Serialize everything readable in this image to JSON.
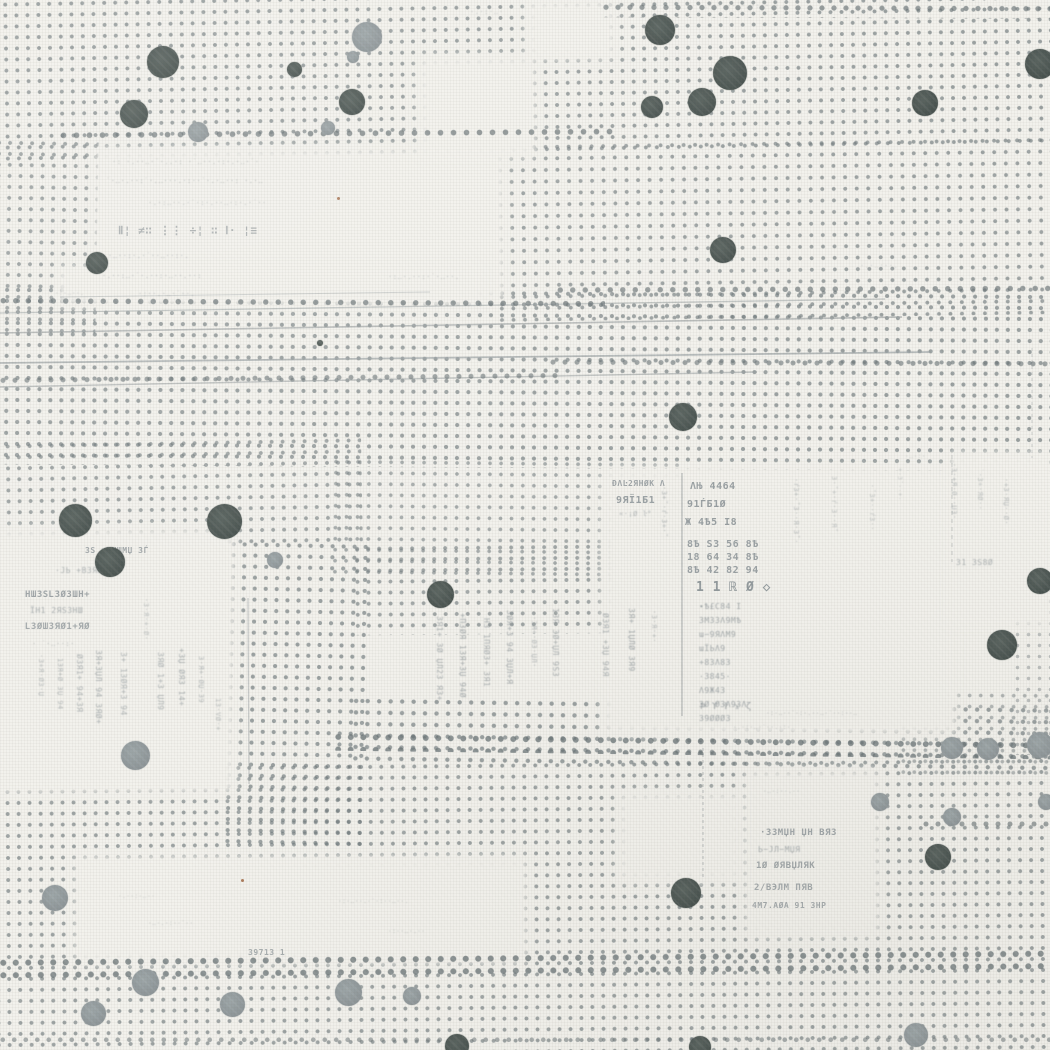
{
  "pattern": {
    "colors": {
      "background": "#f2f1ec",
      "grid_dot": "rgba(112,122,125,0.85)",
      "heavy_dot": "rgba(104,114,117,0.9)",
      "dot_dark": "#47514e",
      "dot_dark_hi": "#59635f",
      "dot_gray": "#8d9598",
      "dot_gray_hi": "#9da6a8",
      "line": "#99a0a2",
      "text": "#828b90",
      "rust": "#9a5f38"
    },
    "dot_patches": [
      {
        "x": -10,
        "y": -10,
        "w": 1075,
        "h": 165,
        "r": -1,
        "sp": 11,
        "ds": 1.7,
        "o": 0.8
      },
      {
        "x": -8,
        "y": 138,
        "w": 105,
        "h": 195,
        "r": 1,
        "sp": 11,
        "ds": 1.7,
        "o": 0.75
      },
      {
        "x": 495,
        "y": 138,
        "w": 560,
        "h": 180,
        "r": -0.8,
        "sp": 11.5,
        "ds": 1.7,
        "o": 0.78
      },
      {
        "x": -10,
        "y": 288,
        "w": 1070,
        "h": 180,
        "r": 0.4,
        "sp": 11,
        "ds": 1.8,
        "o": 0.8
      },
      {
        "x": -8,
        "y": 438,
        "w": 370,
        "h": 112,
        "r": -1,
        "sp": 11,
        "ds": 1.7,
        "o": 0.75
      },
      {
        "x": 225,
        "y": 540,
        "w": 140,
        "h": 310,
        "r": 1.2,
        "sp": 11,
        "ds": 1.8,
        "o": 0.8
      },
      {
        "x": 330,
        "y": 458,
        "w": 355,
        "h": 120,
        "r": 0.6,
        "sp": 11,
        "ds": 1.6,
        "o": 0.7
      },
      {
        "x": 352,
        "y": 542,
        "w": 315,
        "h": 92,
        "r": -0.5,
        "sp": 11,
        "ds": 1.7,
        "o": 0.75
      },
      {
        "x": 350,
        "y": 700,
        "w": 705,
        "h": 68,
        "r": 0.8,
        "sp": 11.5,
        "ds": 1.9,
        "o": 0.8
      },
      {
        "x": -8,
        "y": 760,
        "w": 1070,
        "h": 300,
        "r": -0.5,
        "sp": 11,
        "ds": 1.7,
        "o": 0.78
      },
      {
        "x": 1012,
        "y": 585,
        "w": 40,
        "h": 170,
        "r": 0,
        "sp": 11,
        "ds": 1.5,
        "o": 0.5
      },
      {
        "x": 898,
        "y": 690,
        "w": 155,
        "h": 85,
        "r": 0.3,
        "sp": 11,
        "ds": 1.6,
        "o": 0.6
      }
    ],
    "blank_patches": [
      {
        "x": 95,
        "y": 148,
        "w": 410,
        "h": 152
      },
      {
        "x": 58,
        "y": 266,
        "w": 425,
        "h": 40
      },
      {
        "x": 418,
        "y": 56,
        "w": 118,
        "h": 102
      },
      {
        "x": 526,
        "y": 0,
        "w": 90,
        "h": 60
      },
      {
        "x": -5,
        "y": 528,
        "w": 240,
        "h": 265
      },
      {
        "x": 602,
        "y": 468,
        "w": 355,
        "h": 267
      },
      {
        "x": 75,
        "y": 856,
        "w": 452,
        "h": 108
      },
      {
        "x": 745,
        "y": 770,
        "w": 135,
        "h": 168
      },
      {
        "x": 618,
        "y": 792,
        "w": 125,
        "h": 90
      },
      {
        "x": 948,
        "y": 452,
        "w": 104,
        "h": 175
      }
    ],
    "heavy_rows": [
      {
        "x": 55,
        "y": 125,
        "w": 558,
        "h": 16,
        "r": -0.4,
        "sp": 13,
        "ds": 2.5,
        "o": 0.8
      },
      {
        "x": 598,
        "y": 0,
        "w": 455,
        "h": 18,
        "r": 0.2,
        "sp": 12,
        "ds": 2.3,
        "o": 0.75
      },
      {
        "x": -5,
        "y": 294,
        "w": 610,
        "h": 14,
        "r": 0.3,
        "sp": 12.5,
        "ds": 2.4,
        "o": 0.8
      },
      {
        "x": 552,
        "y": 281,
        "w": 500,
        "h": 14,
        "r": -0.2,
        "sp": 12.5,
        "ds": 2.4,
        "o": 0.75
      },
      {
        "x": 330,
        "y": 733,
        "w": 722,
        "h": 22,
        "r": 0.7,
        "sp": 12.5,
        "ds": 2.6,
        "o": 0.85
      },
      {
        "x": -5,
        "y": 950,
        "w": 1058,
        "h": 24,
        "r": -0.5,
        "sp": 12.5,
        "ds": 2.7,
        "o": 0.85
      },
      {
        "x": -5,
        "y": 370,
        "w": 565,
        "h": 13,
        "r": -0.5,
        "sp": 12,
        "ds": 2.2,
        "o": 0.7
      },
      {
        "x": 545,
        "y": 355,
        "w": 508,
        "h": 13,
        "r": 0.2,
        "sp": 12,
        "ds": 2.2,
        "o": 0.7
      },
      {
        "x": 918,
        "y": 816,
        "w": 134,
        "h": 12,
        "r": 0,
        "sp": 12,
        "ds": 2.2,
        "o": 0.7
      },
      {
        "x": -5,
        "y": 1032,
        "w": 1058,
        "h": 16,
        "r": 0,
        "sp": 11.5,
        "ds": 2,
        "o": 0.6
      }
    ],
    "lines": [
      {
        "x1": 0,
        "y1": 313,
        "x2": 885,
        "y2": 299,
        "w": 1.3,
        "o": 0.55
      },
      {
        "x1": 0,
        "y1": 333,
        "x2": 902,
        "y2": 317,
        "w": 1.6,
        "o": 0.65
      },
      {
        "x1": 0,
        "y1": 363,
        "x2": 930,
        "y2": 352,
        "w": 1.8,
        "o": 0.7
      },
      {
        "x1": 0,
        "y1": 387,
        "x2": 757,
        "y2": 372,
        "w": 1.4,
        "o": 0.6
      },
      {
        "x1": 60,
        "y1": 297,
        "x2": 430,
        "y2": 292,
        "w": 1,
        "o": 0.4
      },
      {
        "x1": 682,
        "y1": 473,
        "x2": 682,
        "y2": 716,
        "w": 1.4,
        "o": 0.6
      },
      {
        "x1": 952,
        "y1": 455,
        "x2": 952,
        "y2": 562,
        "w": 1,
        "o": 0.45,
        "dash": 4
      },
      {
        "x1": 1032,
        "y1": 348,
        "x2": 1032,
        "y2": 458,
        "w": 1,
        "o": 0.4,
        "dash": 3
      },
      {
        "x1": 703,
        "y1": 748,
        "x2": 703,
        "y2": 878,
        "w": 1.2,
        "o": 0.5,
        "dash": 3
      },
      {
        "x1": 248,
        "y1": 598,
        "x2": 249,
        "y2": 784,
        "w": 1.2,
        "o": 0.5
      }
    ],
    "big_dots": [
      {
        "x": 163,
        "y": 62,
        "d": 32,
        "c": "dark"
      },
      {
        "x": 134,
        "y": 114,
        "d": 28,
        "c": "dark"
      },
      {
        "x": 97,
        "y": 263,
        "d": 22,
        "c": "dark"
      },
      {
        "x": 294,
        "y": 69,
        "d": 15,
        "c": "dark"
      },
      {
        "x": 352,
        "y": 102,
        "d": 26,
        "c": "dark"
      },
      {
        "x": 660,
        "y": 30,
        "d": 30,
        "c": "dark"
      },
      {
        "x": 730,
        "y": 73,
        "d": 34,
        "c": "dark"
      },
      {
        "x": 702,
        "y": 102,
        "d": 28,
        "c": "dark"
      },
      {
        "x": 652,
        "y": 107,
        "d": 22,
        "c": "dark"
      },
      {
        "x": 925,
        "y": 103,
        "d": 26,
        "c": "dark"
      },
      {
        "x": 1040,
        "y": 64,
        "d": 30,
        "c": "dark"
      },
      {
        "x": 723,
        "y": 250,
        "d": 26,
        "c": "dark"
      },
      {
        "x": 683,
        "y": 417,
        "d": 28,
        "c": "dark"
      },
      {
        "x": 75,
        "y": 520,
        "d": 33,
        "c": "dark"
      },
      {
        "x": 224,
        "y": 521,
        "d": 35,
        "c": "dark"
      },
      {
        "x": 110,
        "y": 562,
        "d": 30,
        "c": "dark"
      },
      {
        "x": 440,
        "y": 594,
        "d": 27,
        "c": "dark"
      },
      {
        "x": 1002,
        "y": 645,
        "d": 30,
        "c": "dark"
      },
      {
        "x": 1040,
        "y": 581,
        "d": 26,
        "c": "dark"
      },
      {
        "x": 686,
        "y": 893,
        "d": 30,
        "c": "dark"
      },
      {
        "x": 938,
        "y": 857,
        "d": 26,
        "c": "dark"
      },
      {
        "x": 457,
        "y": 1046,
        "d": 24,
        "c": "dark"
      },
      {
        "x": 700,
        "y": 1047,
        "d": 22,
        "c": "dark"
      },
      {
        "x": 320,
        "y": 343,
        "d": 6,
        "c": "dark"
      },
      {
        "x": 367,
        "y": 37,
        "d": 30,
        "c": "gray"
      },
      {
        "x": 353,
        "y": 57,
        "d": 12,
        "c": "gray"
      },
      {
        "x": 198,
        "y": 132,
        "d": 20,
        "c": "gray"
      },
      {
        "x": 328,
        "y": 128,
        "d": 14,
        "c": "gray"
      },
      {
        "x": 275,
        "y": 560,
        "d": 16,
        "c": "gray"
      },
      {
        "x": 135,
        "y": 755,
        "d": 29,
        "c": "gray"
      },
      {
        "x": 55,
        "y": 898,
        "d": 26,
        "c": "gray"
      },
      {
        "x": 145,
        "y": 982,
        "d": 27,
        "c": "gray"
      },
      {
        "x": 93,
        "y": 1013,
        "d": 25,
        "c": "gray"
      },
      {
        "x": 232,
        "y": 1004,
        "d": 25,
        "c": "gray"
      },
      {
        "x": 348,
        "y": 992,
        "d": 27,
        "c": "gray"
      },
      {
        "x": 412,
        "y": 996,
        "d": 18,
        "c": "gray"
      },
      {
        "x": 916,
        "y": 1035,
        "d": 24,
        "c": "gray"
      },
      {
        "x": 952,
        "y": 748,
        "d": 22,
        "c": "gray"
      },
      {
        "x": 988,
        "y": 749,
        "d": 22,
        "c": "gray"
      },
      {
        "x": 1040,
        "y": 745,
        "d": 26,
        "c": "gray"
      },
      {
        "x": 952,
        "y": 817,
        "d": 18,
        "c": "gray"
      },
      {
        "x": 1046,
        "y": 802,
        "d": 16,
        "c": "gray"
      },
      {
        "x": 880,
        "y": 802,
        "d": 18,
        "c": "gray"
      }
    ],
    "rust_specks": [
      {
        "x": 337,
        "y": 197
      },
      {
        "x": 241,
        "y": 879
      }
    ],
    "fragments": [
      {
        "x": 112,
        "y": 158,
        "t": "·: ·.··‥·˙·..·: ·˙‥··.·:·.·‥·˙·",
        "fs": 7,
        "o": 0.5
      },
      {
        "x": 106,
        "y": 177,
        "t": "˙·‥·.··:˙·.‥···.·:··˙·.·‥··: ·.·‥",
        "fs": 7,
        "o": 0.55
      },
      {
        "x": 148,
        "y": 199,
        "t": "·.·:‥··.·˙·:·.··‥·:·.·˙··",
        "fs": 7,
        "o": 0.45
      },
      {
        "x": 118,
        "y": 224,
        "t": "Ⅱ¦ ≠∷  ⋮⋮ ÷¦  ∷  Ⅰ· ¦≡",
        "fs": 11,
        "o": 0.6,
        "b": 1
      },
      {
        "x": 108,
        "y": 252,
        "t": "·‥··:·.·˙··‥··:·.",
        "fs": 7,
        "o": 0.5
      },
      {
        "x": 102,
        "y": 272,
        "t": "·.··:‥·˙·.··:·‥··.··:",
        "fs": 7,
        "o": 0.5
      },
      {
        "x": 138,
        "y": 290,
        "t": "·:··.·‥·˙··.",
        "fs": 7,
        "o": 0.45
      },
      {
        "x": 698,
        "y": 2,
        "t": "·‥·:·.··˙·‥·:··.·‥",
        "fs": 7,
        "o": 0.5
      },
      {
        "x": 470,
        "y": 8,
        "t": "·.·:·‥·",
        "fs": 7,
        "o": 0.4
      },
      {
        "x": 388,
        "y": 273,
        "t": "·:‥·.··:·˙·‥··.",
        "fs": 7,
        "o": 0.45
      },
      {
        "x": 860,
        "y": 262,
        "t": "·.·‥:··.",
        "fs": 7,
        "o": 0.4
      },
      {
        "x": 55,
        "y": 290,
        "t": "·:·‥··.",
        "fs": 6,
        "o": 0.4
      },
      {
        "x": 905,
        "y": 453,
        "t": "·‥·:·",
        "fs": 6,
        "o": 0.4
      },
      {
        "x": 612,
        "y": 479,
        "t": "ĐΛĿ2ЯНØК Λ",
        "fs": 8,
        "o": 0.75,
        "b": 1
      },
      {
        "x": 616,
        "y": 495,
        "t": "9ЯЇ1Б1",
        "fs": 10,
        "o": 0.8,
        "b": 1
      },
      {
        "x": 619,
        "y": 510,
        "t": "«·¡Ø ŀ°",
        "fs": 7,
        "o": 0.55
      },
      {
        "x": 690,
        "y": 481,
        "t": "ΛЊ 4464",
        "fs": 10,
        "o": 0.8,
        "b": 1
      },
      {
        "x": 687,
        "y": 499,
        "t": "91ЃБ1Ø",
        "fs": 10,
        "o": 0.8,
        "b": 1
      },
      {
        "x": 685,
        "y": 517,
        "t": "Ж 4Ѣ5 І8",
        "fs": 10,
        "o": 0.8,
        "b": 1
      },
      {
        "x": 687,
        "y": 538,
        "t": "8Ѣ ЅЗ 56 8Ѣ\n18 64 З4 8Ѣ\n8Ѣ 42 82 94",
        "fs": 10,
        "o": 0.78,
        "b": 1,
        "lh": 13
      },
      {
        "x": 696,
        "y": 580,
        "t": "1 1 ℝ Ø ◇",
        "fs": 13,
        "o": 0.85,
        "b": 1
      },
      {
        "x": 699,
        "y": 600,
        "t": "∙Ѣ£С84 І\nЗМЗЗΛ9МѢ\nɯ−9ЯΛМ9\nɯЇЬΛ9\n+8ЗΛ8З\n·З845·\nΛ9Ж4З\nЗØ ØЗΛ9ЗΛ\nЗ9ØØØЗ",
        "fs": 8,
        "o": 0.7,
        "lh": 14
      },
      {
        "x": 800,
        "y": 478,
        "t": "·ŕЗ+·˚З··Я·З˚·",
        "fs": 7,
        "o": 0.5,
        "r": 1
      },
      {
        "x": 838,
        "y": 476,
        "t": "З·˚+·ŕ·З··Я˚",
        "fs": 7,
        "o": 0.45,
        "r": 1
      },
      {
        "x": 876,
        "y": 484,
        "t": "·˚З+··ŕЗ··",
        "fs": 7,
        "o": 0.45,
        "r": 1
      },
      {
        "x": 903,
        "y": 468,
        "t": "+·З˚··+·",
        "fs": 6,
        "o": 0.4,
        "r": 1
      },
      {
        "x": 668,
        "y": 486,
        "t": "·З+˚·ŕ·З+·˚",
        "fs": 7,
        "o": 0.55,
        "r": 1
      },
      {
        "x": 85,
        "y": 546,
        "t": "ЗЅ ıЗНШМЏ ЗЃ",
        "fs": 8,
        "o": 0.7,
        "b": 1
      },
      {
        "x": 55,
        "y": 566,
        "t": "·ЈЬ +ВЗЯНШ+",
        "fs": 8,
        "o": 0.6
      },
      {
        "x": 25,
        "y": 590,
        "t": "НШЗЅԼЗØЗШН+",
        "fs": 9,
        "o": 0.75,
        "b": 1
      },
      {
        "x": 30,
        "y": 606,
        "t": "ЇН1 2ЯЅЗНШ",
        "fs": 8,
        "o": 0.65
      },
      {
        "x": 25,
        "y": 622,
        "t": "ԼЗØШЗЯØ1+ЯØ",
        "fs": 9,
        "o": 0.7,
        "b": 1
      },
      {
        "x": 32,
        "y": 640,
        "t": "· ˙·‥··:·",
        "fs": 7,
        "o": 0.5
      },
      {
        "x": 103,
        "y": 650,
        "t": "ЗЯ+ЗЏЛ 94 ЗЯØ+",
        "fs": 8,
        "o": 0.65,
        "r": 1
      },
      {
        "x": 84,
        "y": 654,
        "t": "ØЗЯ1+ 94+ЗЯ",
        "fs": 8,
        "o": 0.6,
        "r": 1
      },
      {
        "x": 64,
        "y": 658,
        "t": "1ЗЯ+Ø ЗЏ 94",
        "fs": 7,
        "o": 0.55,
        "r": 1
      },
      {
        "x": 45,
        "y": 654,
        "t": "·З+Я·ØЗ·Џ",
        "fs": 7,
        "o": 0.5,
        "r": 1
      },
      {
        "x": 128,
        "y": 652,
        "t": "З+ 1ЗØЯ+З 94",
        "fs": 8,
        "o": 0.6,
        "r": 1
      },
      {
        "x": 150,
        "y": 598,
        "t": "·З·Я·+·Ø·",
        "fs": 7,
        "o": 0.45,
        "r": 1
      },
      {
        "x": 165,
        "y": 652,
        "t": "ЗЯØ 1+З ЏЛ9",
        "fs": 8,
        "o": 0.6,
        "r": 1
      },
      {
        "x": 186,
        "y": 648,
        "t": "+ЗЏ ØЯЗ 14+",
        "fs": 8,
        "o": 0.65,
        "r": 1
      },
      {
        "x": 205,
        "y": 656,
        "t": "З·Я+·ØЏ·З9",
        "fs": 7,
        "o": 0.55,
        "r": 1
      },
      {
        "x": 222,
        "y": 698,
        "t": "1З·VØ·+",
        "fs": 7,
        "o": 0.5,
        "r": 1
      },
      {
        "x": 444,
        "y": 616,
        "t": "ЗЯ1+ ЗØ ЏЛ2З ЯЗ+",
        "fs": 8,
        "o": 0.65,
        "r": 1
      },
      {
        "x": 467,
        "y": 613,
        "t": "+ПЗØЯ 1ЗЯ+ЗЏ 94Ø",
        "fs": 8,
        "o": 0.7,
        "r": 1
      },
      {
        "x": 491,
        "y": 618,
        "t": "НЗ 1ПЯØЗ+ ЗЯ1",
        "fs": 8,
        "o": 0.65,
        "r": 1
      },
      {
        "x": 514,
        "y": 610,
        "t": "ЗØЯ+З 94 ЗЏЛ+Я",
        "fs": 8,
        "o": 0.7,
        "r": 1
      },
      {
        "x": 538,
        "y": 616,
        "t": "·ЗЯ+·ØЗ·ЏЛ·",
        "fs": 7,
        "o": 0.55,
        "r": 1
      },
      {
        "x": 560,
        "y": 608,
        "t": "1ЗЯ ЗØ+ЏЛ 9ЅЗ",
        "fs": 8,
        "o": 0.65,
        "r": 1
      },
      {
        "x": 610,
        "y": 613,
        "t": "ØЗЯ1 +ЗЏ 94Я",
        "fs": 8,
        "o": 0.65,
        "r": 1
      },
      {
        "x": 636,
        "y": 608,
        "t": "ЗЯ+ 1ЏЛØ ЗЯ9",
        "fs": 8,
        "o": 0.7,
        "r": 1
      },
      {
        "x": 658,
        "y": 610,
        "t": "·З·Я·+·",
        "fs": 7,
        "o": 0.5,
        "r": 1
      },
      {
        "x": 700,
        "y": 701,
        "t": "Ϸ ϒ Ϯ ϫ ζ",
        "fs": 9,
        "o": 0.7
      },
      {
        "x": 766,
        "y": 710,
        "t": "·:·‥··˙·:·.··‥·˙··:··‥",
        "fs": 6,
        "o": 0.5
      },
      {
        "x": 733,
        "y": 724,
        "t": "·.·:·‥·˙··.·:·",
        "fs": 6,
        "o": 0.45
      },
      {
        "x": 763,
        "y": 788,
        "t": "·‥·:··.··",
        "fs": 6,
        "o": 0.45
      },
      {
        "x": 760,
        "y": 828,
        "t": "·ЗЗМЏН ЏН ВЯЗ",
        "fs": 9,
        "o": 0.75,
        "b": 1
      },
      {
        "x": 758,
        "y": 845,
        "t": "Ь−ЈЛ−МЏЯ",
        "fs": 8,
        "o": 0.65
      },
      {
        "x": 756,
        "y": 861,
        "t": "1Ø ØЯВЏЛЯК",
        "fs": 9,
        "o": 0.72,
        "b": 1
      },
      {
        "x": 754,
        "y": 883,
        "t": "2/ВЭЛМ ПЯВ",
        "fs": 9,
        "o": 0.7,
        "b": 1
      },
      {
        "x": 752,
        "y": 901,
        "t": "4М7.АØА 91 ЗНР",
        "fs": 8,
        "o": 0.68,
        "b": 1
      },
      {
        "x": 338,
        "y": 898,
        "t": "·:·‥··.·˙·:··‥··.",
        "fs": 6,
        "o": 0.45
      },
      {
        "x": 118,
        "y": 893,
        "t": "·.··:·‥··",
        "fs": 6,
        "o": 0.4
      },
      {
        "x": 148,
        "y": 920,
        "t": "·‥·.·:··˙··",
        "fs": 6,
        "o": 0.45
      },
      {
        "x": 248,
        "y": 948,
        "t": "З971З 1",
        "fs": 8,
        "o": 0.65,
        "b": 1
      },
      {
        "x": 388,
        "y": 928,
        "t": "·:··‥·.··",
        "fs": 6,
        "o": 0.45
      },
      {
        "x": 958,
        "y": 463,
        "t": "·З·+Я·Ø··ЏЗ·",
        "fs": 7,
        "o": 0.5,
        "r": 1
      },
      {
        "x": 984,
        "y": 468,
        "t": "˙·З+·ЯØ··",
        "fs": 7,
        "o": 0.45,
        "r": 1
      },
      {
        "x": 1010,
        "y": 478,
        "t": "·+З·ЯЏ··Ø·",
        "fs": 7,
        "o": 0.5,
        "r": 1
      },
      {
        "x": 956,
        "y": 558,
        "t": "З1 ЗЅ8Ø",
        "fs": 8,
        "o": 0.6
      }
    ]
  }
}
